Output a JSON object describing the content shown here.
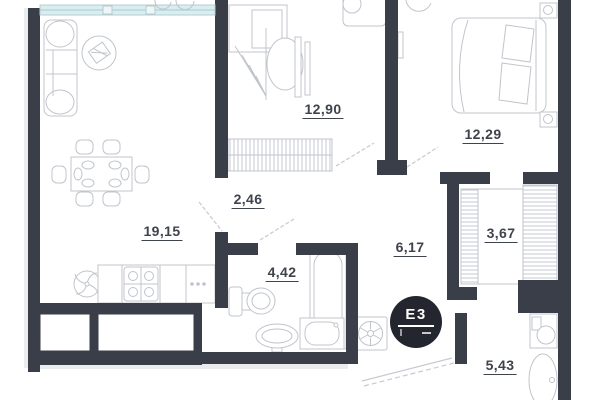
{
  "rooms": [
    {
      "id": "living-room",
      "area": "19,15"
    },
    {
      "id": "bedroom-1",
      "area": "12,90"
    },
    {
      "id": "bedroom-2",
      "area": "12,29"
    },
    {
      "id": "hallway",
      "area": "2,46"
    },
    {
      "id": "bathroom",
      "area": "4,42"
    },
    {
      "id": "corridor",
      "area": "6,17"
    },
    {
      "id": "wardrobe",
      "area": "3,67"
    },
    {
      "id": "bathroom-2",
      "area": "5,43"
    }
  ],
  "badge": {
    "label": "E3"
  },
  "colors": {
    "wall": "#3a3e48",
    "window_glass": "#d9eef0",
    "furniture_line": "#c0c4cb",
    "badge_background": "#23262e",
    "label_text": "#3f434c"
  }
}
